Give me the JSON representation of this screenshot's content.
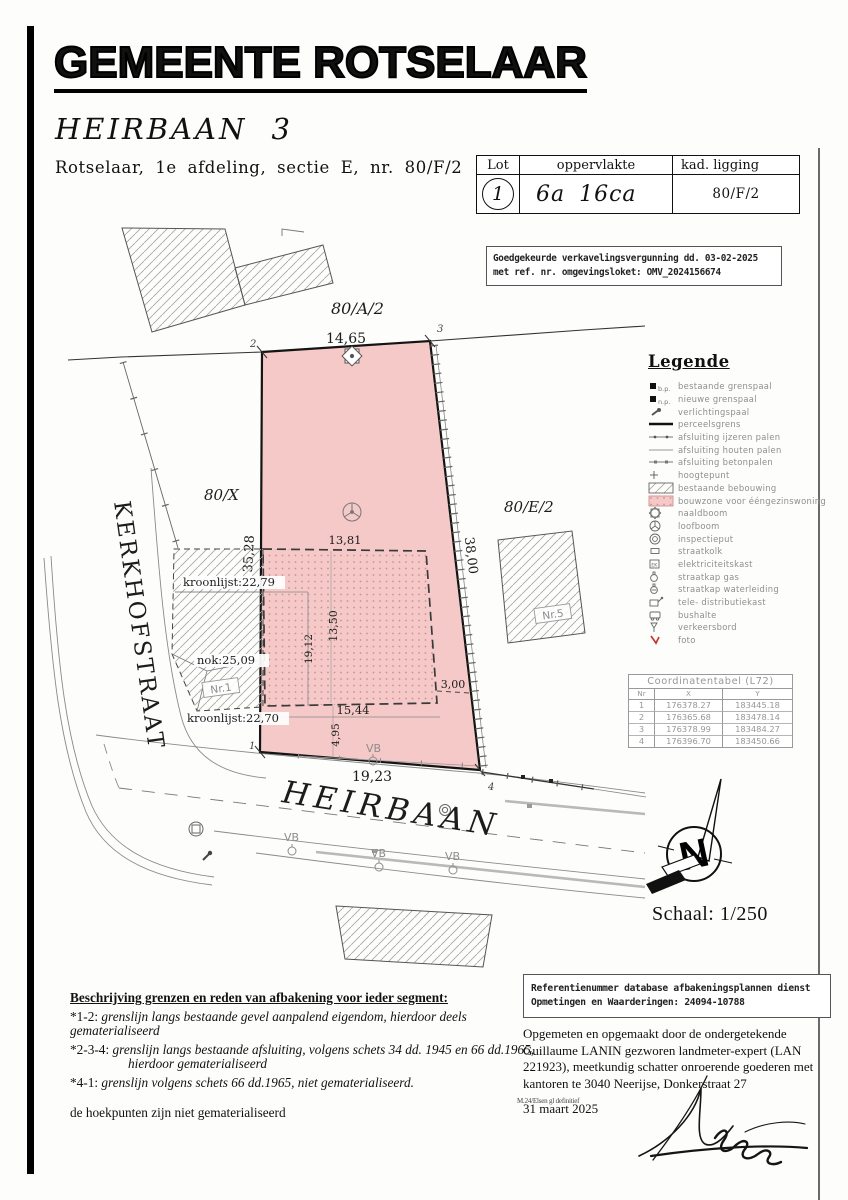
{
  "header": {
    "title": "GEMEENTE ROTSELAAR",
    "subtitle": "HEIRBAAN 3",
    "cadastral": "Rotselaar, 1e afdeling, sectie E, nr. 80/F/2"
  },
  "lot_table": {
    "col_lot": "Lot",
    "col_area": "oppervlakte",
    "col_ligging": "kad. ligging",
    "lot": "1",
    "area": "6a 16ca",
    "ligging": "80/F/2"
  },
  "approval": {
    "line1": "Goedgekeurde verkavelingsvergunning dd. 03-02-2025",
    "line2": "met ref. nr. omgevingsloket: OMV_2024156674"
  },
  "plan": {
    "parcels": {
      "a2": "80/A/2",
      "x": "80/X",
      "e2": "80/E/2"
    },
    "streets": {
      "left": "KERKHOFSTRAAT",
      "bottom": "HEIRBAAN"
    },
    "buildings": {
      "nr1": "Nr.1",
      "nr5": "Nr.5"
    },
    "dims": {
      "top": "14,65",
      "left": "35,28",
      "right": "38,00",
      "bottom": "19,23",
      "bz_top": "13,81",
      "bz_height": "13,50",
      "bz_inner": "19,12",
      "bz_right": "3,00",
      "bz_bottom": "15,44",
      "bz_below": "4,95"
    },
    "heights": {
      "kroonlijst_n": "kroonlijst:22,79",
      "nok": "nok:25,09",
      "kroonlijst_s": "kroonlijst:22,70"
    },
    "points": {
      "p1": "1",
      "p2": "2",
      "p3": "3",
      "p4": "4"
    },
    "vb": "VB"
  },
  "legend": {
    "title": "Legende",
    "items": [
      {
        "sub": "b.p.",
        "label": "bestaande grenspaal"
      },
      {
        "sub": "n.p.",
        "label": "nieuwe grenspaal"
      },
      {
        "label": "verlichtingspaal"
      },
      {
        "label": "perceelsgrens"
      },
      {
        "label": "afsluiting ijzeren palen"
      },
      {
        "label": "afsluiting houten palen"
      },
      {
        "label": "afsluiting betonpalen"
      },
      {
        "label": "hoogtepunt"
      },
      {
        "label": "bestaande bebouwing"
      },
      {
        "label": "bouwzone voor ééngezinswoning"
      },
      {
        "label": "naaldboom"
      },
      {
        "label": "loofboom"
      },
      {
        "label": "inspectieput"
      },
      {
        "label": "straatkolk"
      },
      {
        "label": "elektriciteitskast"
      },
      {
        "label": "straatkap gas"
      },
      {
        "label": "straatkap waterleiding"
      },
      {
        "label": "tele- distributiekast"
      },
      {
        "label": "bushalte"
      },
      {
        "label": "verkeersbord"
      },
      {
        "label": "foto"
      }
    ]
  },
  "coord_table": {
    "title": "Coordinatentabel (L72)",
    "headers": [
      "Nr",
      "X",
      "Y"
    ],
    "rows": [
      [
        "1",
        "176378.27",
        "183445.18"
      ],
      [
        "2",
        "176365.68",
        "183478.14"
      ],
      [
        "3",
        "176378.99",
        "183484.27"
      ],
      [
        "4",
        "176396.70",
        "183450.66"
      ]
    ]
  },
  "north": {
    "letter": "N",
    "scale": "Schaal: 1/250"
  },
  "description": {
    "heading": "Beschrijving grenzen en reden van afbakening voor ieder segment:",
    "seg1_tag": "*1-2:",
    "seg1": "grenslijn langs bestaande gevel aanpalend eigendom, hierdoor deels gematerialiseerd",
    "seg2_tag": "*2-3-4:",
    "seg2a": "grenslijn langs bestaande afsluiting, volgens schets 34 dd. 1945 en 66 dd.1965,",
    "seg2b": "hierdoor gematerialiseerd",
    "seg3_tag": "*4-1:",
    "seg3": "grenslijn volgens schets 66 dd.1965, niet gematerialiseerd.",
    "footer": "de hoekpunten zijn niet gematerialiseerd"
  },
  "reference": {
    "line1": "Referentienummer database afbakeningsplannen dienst",
    "line2": "Opmetingen en Waarderingen: 24094-10788"
  },
  "surveyor": {
    "text": "Opgemeten en opgemaakt door de ondergetekende Guillaume LANIN gezworen landmeter-expert (LAN 221923), meetkundig schatter onroerende goederen met kantoren te 3040 Neerijse, Donkerstraat 27",
    "date": "31 maart 2025",
    "note": "M.24/Elsen gl definitief"
  },
  "colors": {
    "parcel_pink": "#f5c9c7",
    "bouwzone_dot": "#d08f8f",
    "foto_red": "#c0392b"
  }
}
